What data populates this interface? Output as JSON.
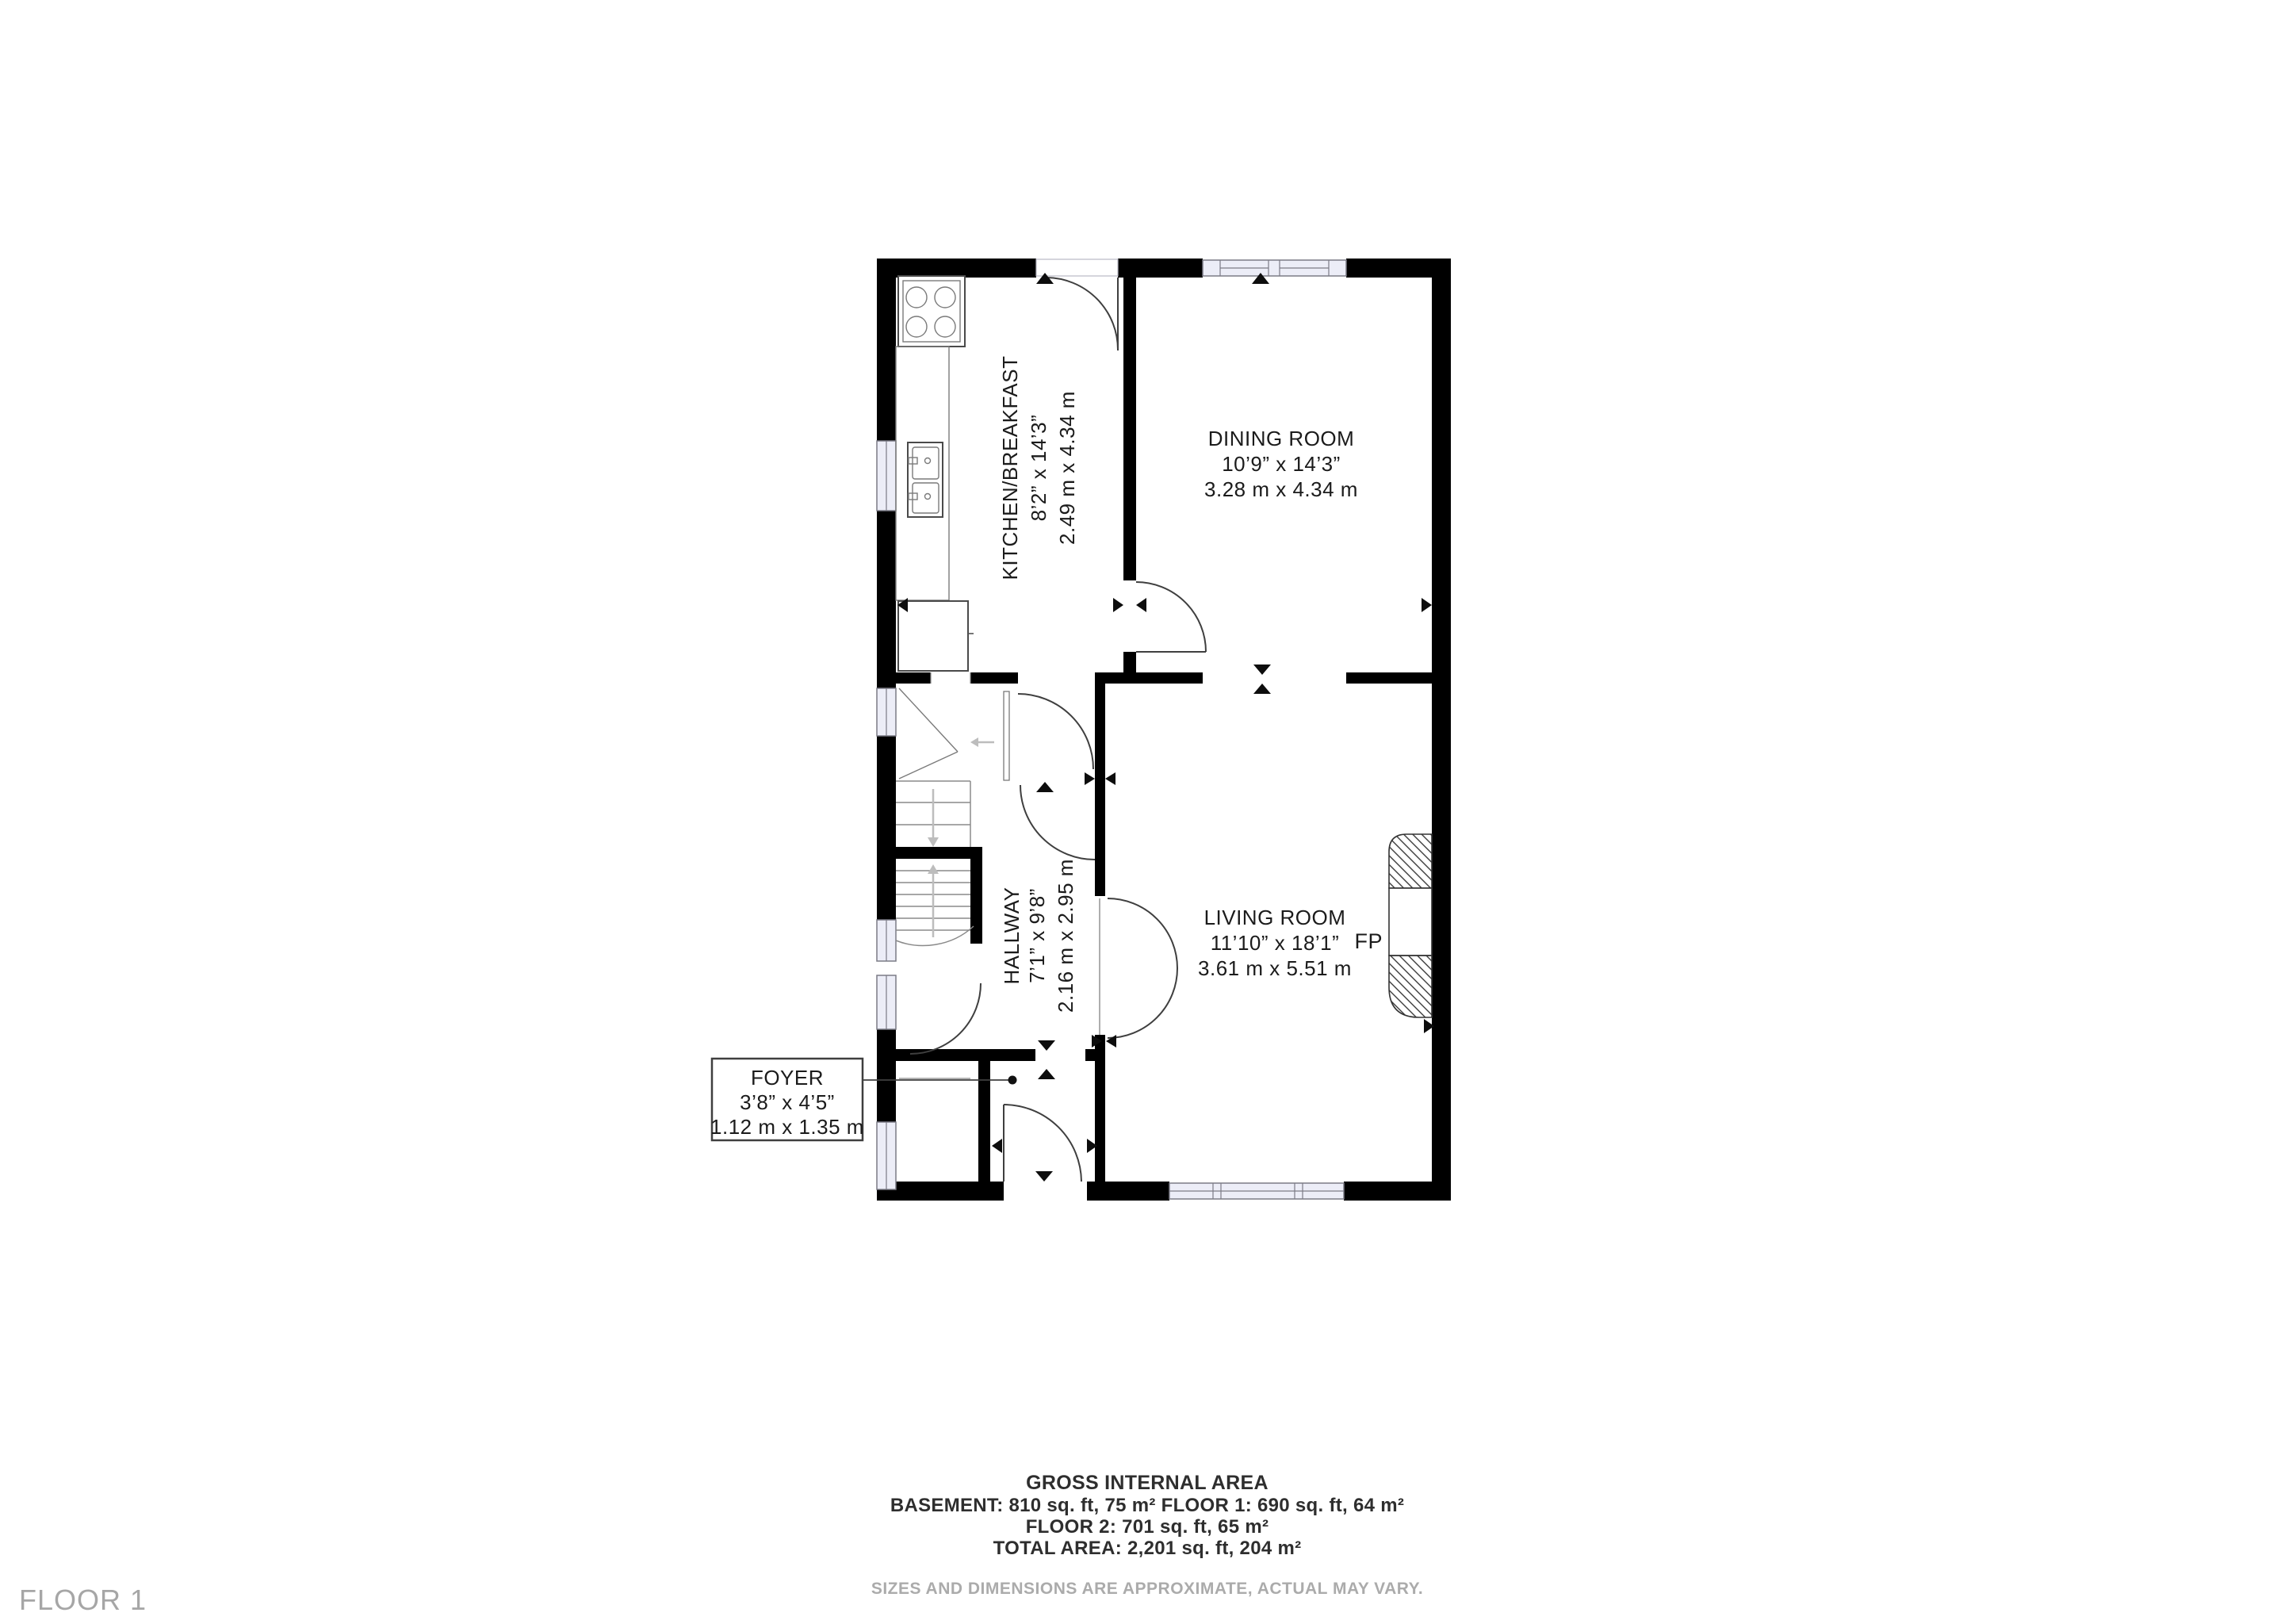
{
  "floor_label": "FLOOR 1",
  "rooms": {
    "kitchen": {
      "name": "KITCHEN/BREAKFAST",
      "size_imperial": "8’2” x 14’3”",
      "size_metric": "2.49 m x 4.34 m"
    },
    "dining": {
      "name": "DINING ROOM",
      "size_imperial": "10’9” x 14’3”",
      "size_metric": "3.28 m x 4.34 m"
    },
    "hallway": {
      "name": "HALLWAY",
      "size_imperial": "7’1” x 9’8”",
      "size_metric": "2.16 m x 2.95 m"
    },
    "living": {
      "name": "LIVING ROOM",
      "size_imperial": "11’10” x 18’1”",
      "size_metric": "3.61 m x 5.51 m"
    },
    "foyer": {
      "name": "FOYER",
      "size_imperial": "3’8” x 4’5”",
      "size_metric": "1.12 m x 1.35 m"
    }
  },
  "fireplace": {
    "label": "FP"
  },
  "footer": {
    "title": "GROSS INTERNAL AREA",
    "line1": "BASEMENT: 810 sq. ft, 75 m² FLOOR 1: 690 sq. ft, 64 m²",
    "line2": "FLOOR 2: 701 sq. ft, 65 m²",
    "line3": "TOTAL AREA: 2,201 sq. ft, 204 m²",
    "disclaimer": "SIZES AND DIMENSIONS ARE APPROXIMATE, ACTUAL MAY VARY."
  },
  "colors": {
    "wall": "#000000",
    "window_fill": "#ecedf7",
    "label_text": "#1b1b1b",
    "muted_text": "#a9a9a9"
  }
}
